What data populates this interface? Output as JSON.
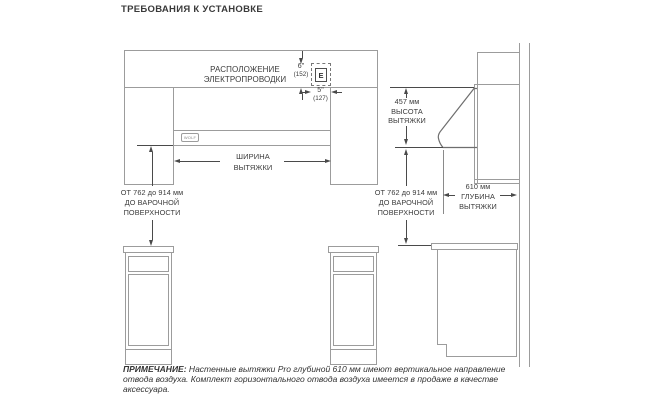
{
  "title": "ТРЕБОВАНИЯ К УСТАНОВКЕ",
  "labels": {
    "wiring": [
      "РАСПОЛОЖЕНИЕ",
      "ЭЛЕКТРОПРОВОДКИ"
    ],
    "dim_6in": [
      "6\"",
      "(152)"
    ],
    "dim_5in": [
      "5\"",
      "(127)"
    ],
    "electrical_box": "E",
    "brand": "WOLF",
    "hood_width": [
      "ШИРИНА",
      "ВЫТЯЖКИ"
    ],
    "hood_height": [
      "457 мм",
      "ВЫСОТА",
      "ВЫТЯЖКИ"
    ],
    "hood_depth": [
      "610 мм",
      "ГЛУБИНА",
      "ВЫТЯЖКИ"
    ],
    "cooktop_left": [
      "ОТ 762 до 914 мм",
      "ДО ВАРОЧНОЙ",
      "ПОВЕРХНОСТИ"
    ],
    "cooktop_right": [
      "ОТ 762 до 914 мм",
      "ДО ВАРОЧНОЙ",
      "ПОВЕРХНОСТИ"
    ]
  },
  "note": {
    "prefix": "ПРИМЕЧАНИЕ:",
    "line1": " Настенные вытяжки Pro глубиной 610 мм имеют вертикальное направление",
    "line2": "отвода воздуха. Комплект горизонтального отвода воздуха имеется в продаже в качестве",
    "line3": "аксессуара."
  },
  "colors": {
    "structure_line": "#9c9c9c",
    "dimension_line": "#4a4a4a",
    "text": "#3b3b3b",
    "background": "#ffffff"
  }
}
